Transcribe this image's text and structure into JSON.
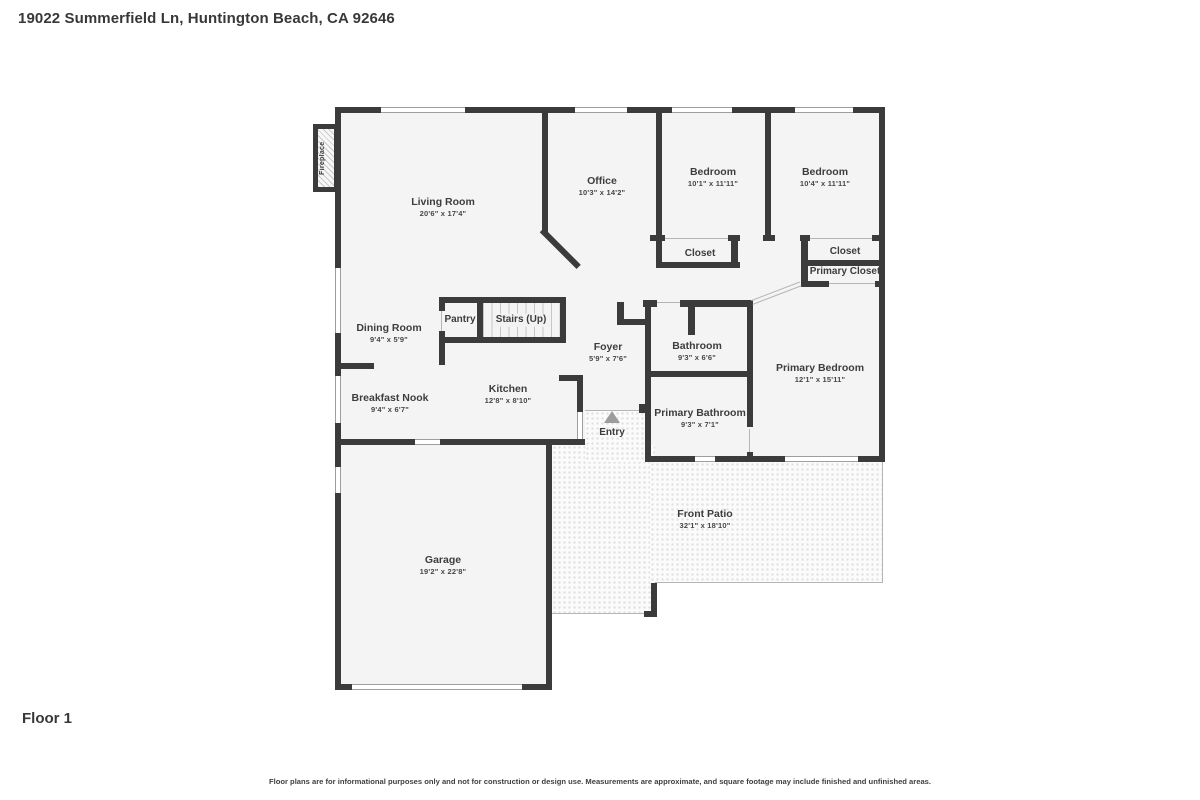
{
  "header": {
    "address": "19022 Summerfield Ln, Huntington Beach, CA 92646"
  },
  "floor": {
    "label": "Floor 1"
  },
  "disclaimer": "Floor plans are for informational purposes only and not for construction or design use. Measurements are approximate, and square footage may include finished and unfinished areas.",
  "colors": {
    "wall": "#3b3b3b",
    "floor": "#f4f4f4",
    "text": "#3d3d3d",
    "patio_dot": "#e1e1e1"
  },
  "rooms": {
    "living_room": {
      "name": "Living Room",
      "dims": "20'6\" x 17'4\""
    },
    "office": {
      "name": "Office",
      "dims": "10'3\" x 14'2\""
    },
    "bedroom_1": {
      "name": "Bedroom",
      "dims": "10'1\" x 11'11\""
    },
    "bedroom_2": {
      "name": "Bedroom",
      "dims": "10'4\" x 11'11\""
    },
    "closet_1": {
      "name": "Closet"
    },
    "closet_2": {
      "name": "Closet"
    },
    "primary_closet": {
      "name": "Primary Closet"
    },
    "dining_room": {
      "name": "Dining Room",
      "dims": "9'4\" x 5'9\""
    },
    "pantry": {
      "name": "Pantry"
    },
    "stairs": {
      "name": "Stairs (Up)"
    },
    "foyer": {
      "name": "Foyer",
      "dims": "5'9\" x 7'6\""
    },
    "bathroom": {
      "name": "Bathroom",
      "dims": "9'3\" x 6'6\""
    },
    "primary_bedroom": {
      "name": "Primary Bedroom",
      "dims": "12'1\" x 15'11\""
    },
    "breakfast_nook": {
      "name": "Breakfast Nook",
      "dims": "9'4\" x 6'7\""
    },
    "kitchen": {
      "name": "Kitchen",
      "dims": "12'8\" x 8'10\""
    },
    "primary_bathroom": {
      "name": "Primary Bathroom",
      "dims": "9'3\" x 7'1\""
    },
    "entry": {
      "name": "Entry"
    },
    "garage": {
      "name": "Garage",
      "dims": "19'2\" x 22'8\""
    },
    "front_patio": {
      "name": "Front Patio",
      "dims": "32'1\" x 18'10\""
    },
    "fireplace": {
      "name": "Fireplace"
    }
  }
}
